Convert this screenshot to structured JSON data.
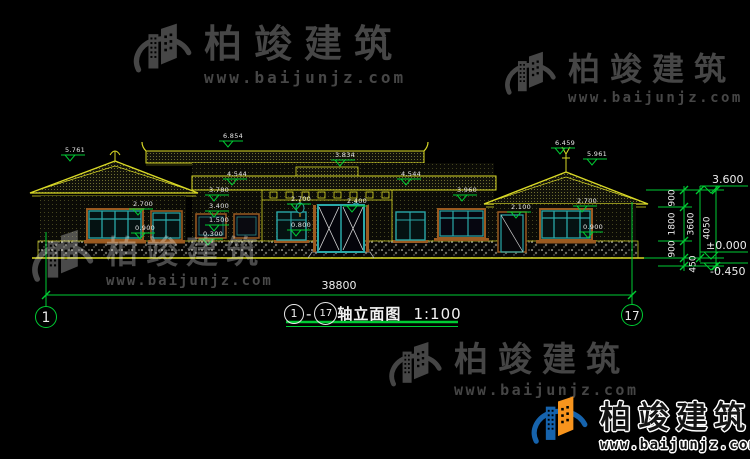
{
  "watermark": {
    "brand": "柏竣建筑",
    "url": "www.baijunjz.com"
  },
  "title_block": {
    "axis_start": "1",
    "separator": "-",
    "axis_end": "17",
    "name": "轴立面图",
    "scale": "1:100"
  },
  "axis_bubbles": {
    "left": "1",
    "right": "17"
  },
  "dimensions": {
    "total_width": "38800",
    "right_chain": [
      "900",
      "1800",
      "900"
    ],
    "story_height": "3600",
    "overall_height": "4050",
    "foundation": "450"
  },
  "elevations": {
    "eave": "3.600",
    "ground": "±0.000",
    "foundation": "-0.450"
  },
  "markers": [
    {
      "value": "5.761",
      "x": 60,
      "y": 147
    },
    {
      "value": "6.854",
      "x": 218,
      "y": 133
    },
    {
      "value": "3.834",
      "x": 330,
      "y": 152
    },
    {
      "value": "4.544",
      "x": 222,
      "y": 171
    },
    {
      "value": "4.544",
      "x": 396,
      "y": 171
    },
    {
      "value": "3.780",
      "x": 204,
      "y": 187
    },
    {
      "value": "3.960",
      "x": 452,
      "y": 187
    },
    {
      "value": "2.700",
      "x": 128,
      "y": 201
    },
    {
      "value": "0.900",
      "x": 130,
      "y": 225
    },
    {
      "value": "3.400",
      "x": 204,
      "y": 203
    },
    {
      "value": "1.500",
      "x": 204,
      "y": 217
    },
    {
      "value": "0.300",
      "x": 198,
      "y": 231
    },
    {
      "value": "2.700",
      "x": 286,
      "y": 196
    },
    {
      "value": "0.800",
      "x": 286,
      "y": 222
    },
    {
      "value": "2.400",
      "x": 342,
      "y": 198
    },
    {
      "value": "2.100",
      "x": 506,
      "y": 204
    },
    {
      "value": "2.700",
      "x": 572,
      "y": 198
    },
    {
      "value": "0.900",
      "x": 578,
      "y": 224
    },
    {
      "value": "6.459",
      "x": 550,
      "y": 140
    },
    {
      "value": "5.961",
      "x": 582,
      "y": 151
    }
  ],
  "colors": {
    "background": "#000000",
    "roof_line": "#d9d926",
    "dim_line": "#00cc33",
    "window": "#2aa8a8",
    "frame": "#9a5a20",
    "text": "#f0f0f0",
    "watermark_gray": "#464646",
    "logo_blue": "#1663ac",
    "logo_orange": "#f7941d"
  }
}
